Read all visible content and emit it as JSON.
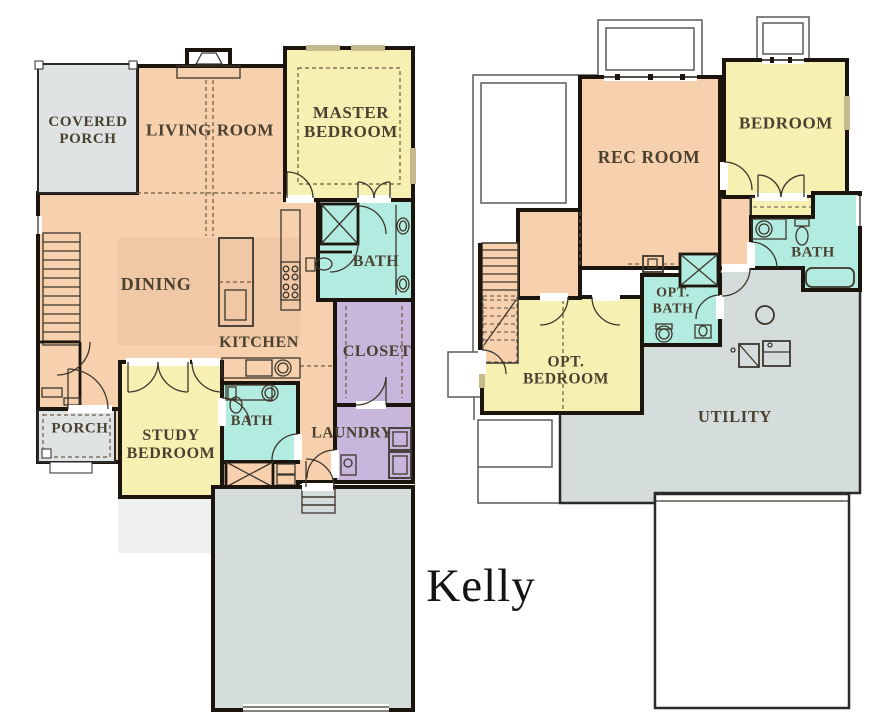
{
  "title": {
    "text": "Kelly"
  },
  "colors": {
    "wall": "#1c150e",
    "room_peach": "#f7d0ae",
    "room_yellow": "#f6f0b2",
    "room_teal": "#b2ebdf",
    "room_purple": "#c9b6dc",
    "porch_gray": "#dfe3e4",
    "utility_gray": "#d5dddc",
    "window_tan": "#c5ba8e",
    "label_text": "#4a4130"
  },
  "floor1": {
    "covered_porch": "COVERED\nPORCH",
    "living_room": "LIVING ROOM",
    "master_bedroom": "MASTER\nBEDROOM",
    "dining": "DINING",
    "master_bath": "BATH",
    "kitchen": "KITCHEN",
    "closet": "CLOSET",
    "porch": "PORCH",
    "study_bedroom": "STUDY\nBEDROOM",
    "hall_bath": "BATH",
    "laundry": "LAUNDRY"
  },
  "floor2": {
    "rec_room": "REC ROOM",
    "bedroom": "BEDROOM",
    "bath": "BATH",
    "opt_bath": "OPT.\nBATH",
    "opt_bedroom": "OPT.\nBEDROOM",
    "utility": "UTILITY"
  }
}
